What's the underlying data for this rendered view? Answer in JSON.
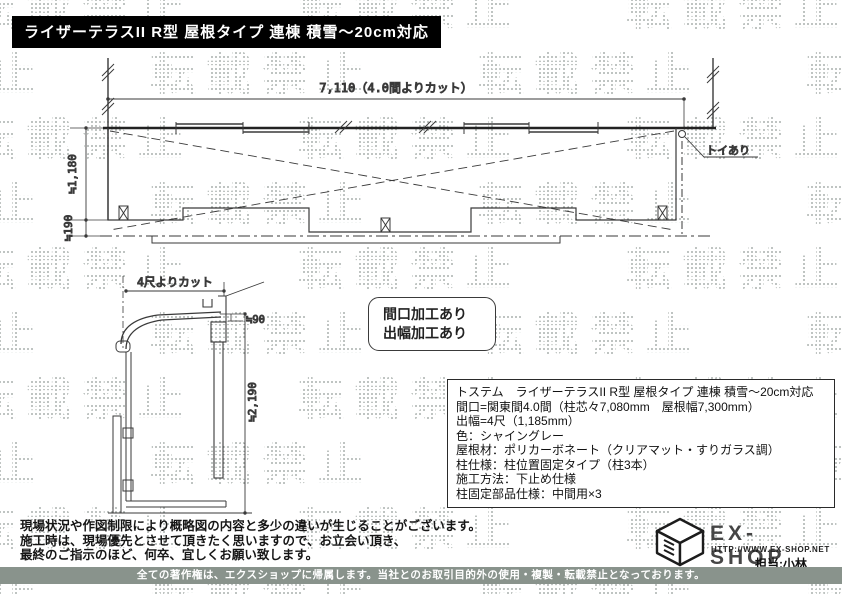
{
  "title_bar": {
    "text": "ライザーテラスII R型 屋根タイプ 連棟 積雪～20cm対応"
  },
  "watermark": {
    "text": "転載禁止"
  },
  "plan_view": {
    "width_dim": "7,110（4.0間よりカット）",
    "depth_dim": "≒1,180",
    "edge_dim": "≒190",
    "drain_label": "トイあり"
  },
  "side_view": {
    "depth_dim": "4尺よりカット",
    "clearance_dim": "≒90",
    "height_dim": "≒2,190"
  },
  "note_box": {
    "line1": "間口加工あり",
    "line2": "出幅加工あり"
  },
  "spec_box": {
    "lines": [
      "トステム　ライザーテラスII R型 屋根タイプ 連棟 積雪～20cm対応",
      "間口=関東間4.0間（柱芯々7,080mm　屋根幅7,300mm）",
      "出幅=4尺（1,185mm）",
      "色：シャイングレー",
      "屋根材：ポリカーボネート（クリアマット・すりガラス調）",
      "柱仕様：柱位置固定タイプ（柱3本）",
      "施工方法：下止め仕様",
      "柱固定部品仕様：中間用×3"
    ]
  },
  "disclaimer": {
    "line1": "現場状況や作図制限により概略図の内容と多少の違いが生じることがございます。",
    "line2": "施工時は、現場優先とさせて頂きたく思いますので、お立会い頂き、",
    "line3": "最終のご指示のほど、何卒、宜しくお願い致します。"
  },
  "footer_logo": {
    "brand": "EX-SHOP",
    "url": "HTTP://WWW.EX-SHOP.NET",
    "contact": "担当:小林"
  },
  "copyright_bar": {
    "text": "全ての著作権は、エクスショップに帰属します。当社とのお取引目的外の使用・複製・転載禁止となっております。"
  },
  "colors": {
    "title_bar_bg": "#000000",
    "copyright_bar_bg": "#89938c",
    "watermark_dot": "#aab1ad",
    "line": "#3a3a3a"
  }
}
